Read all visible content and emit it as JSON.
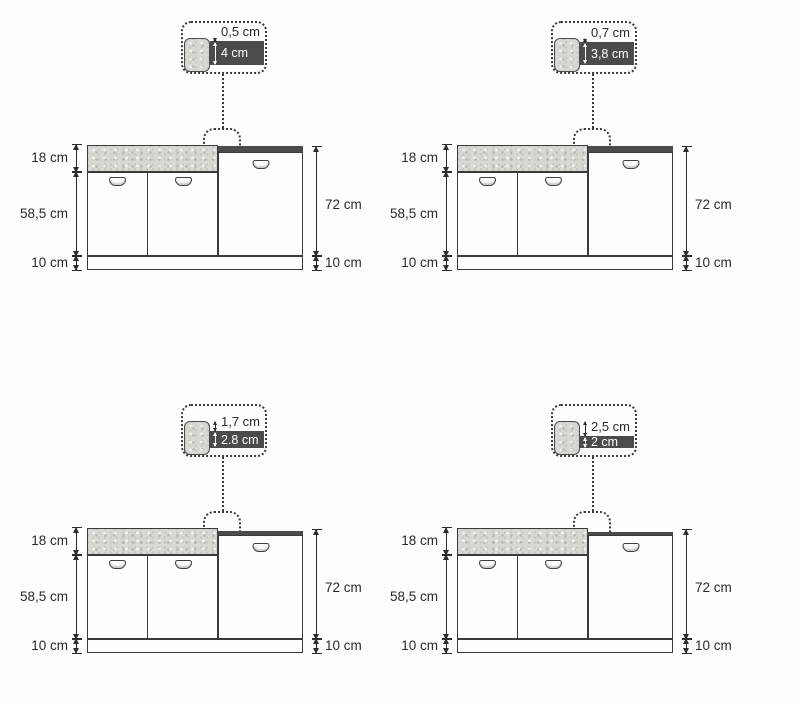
{
  "colors": {
    "background": "#fdfdfc",
    "line": "#3a3a38",
    "worktop_dark": "#4b4b49",
    "panel_gray": "#d8d7d2",
    "text": "#2a2a28",
    "callout_text_on_dark": "#ffffff"
  },
  "diagrams": [
    {
      "position": "top-left",
      "overhang_cm": 0.5,
      "thickness_cm": 4,
      "callout": {
        "overhang_label": "0,5 cm",
        "thickness_label": "4 cm"
      },
      "dims": {
        "left": [
          "18 cm",
          "58,5 cm",
          "10 cm"
        ],
        "right": [
          "72 cm",
          "10 cm"
        ]
      }
    },
    {
      "position": "top-right",
      "overhang_cm": 0.7,
      "thickness_cm": 3.8,
      "callout": {
        "overhang_label": "0,7 cm",
        "thickness_label": "3,8 cm"
      },
      "dims": {
        "left": [
          "18 cm",
          "58,5 cm",
          "10 cm"
        ],
        "right": [
          "72 cm",
          "10 cm"
        ]
      }
    },
    {
      "position": "bottom-left",
      "overhang_cm": 1.7,
      "thickness_cm": 2.8,
      "callout": {
        "overhang_label": "1,7 cm",
        "thickness_label": "2.8 cm"
      },
      "dims": {
        "left": [
          "18 cm",
          "58,5 cm",
          "10 cm"
        ],
        "right": [
          "72 cm",
          "10 cm"
        ]
      }
    },
    {
      "position": "bottom-right",
      "overhang_cm": 2.5,
      "thickness_cm": 2,
      "callout": {
        "overhang_label": "2,5 cm",
        "thickness_label": "2 cm"
      },
      "dims": {
        "left": [
          "18 cm",
          "58,5 cm",
          "10 cm"
        ],
        "right": [
          "72 cm",
          "10 cm"
        ]
      }
    }
  ]
}
